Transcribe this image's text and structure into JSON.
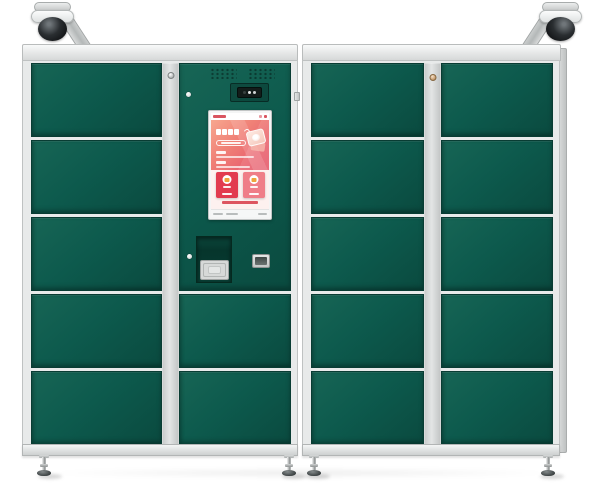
{
  "product": {
    "type": "smart-parcel-locker-cabinets",
    "description": "Two green steel locker cabinets with light gray frames, two dome surveillance cameras on top corners, central control column with touchscreen, QR scanner and card slot, chrome adjustable feet"
  },
  "palette": {
    "door_green": "#0d5a4d",
    "door_green_light": "#176555",
    "door_green_dark": "#0a4a3f",
    "door_edge": "#093c33",
    "frame_light": "#e8eaea",
    "frame_border": "#bfc2c2",
    "strip_silver": "#d9dbdb",
    "chrome": "#9aa0a3",
    "screen_red": "#e55a6b",
    "screen_coral": "#f7a78f",
    "card_red": "#e23b4f",
    "card_coral": "#ef7e88",
    "accent_orange": "#f0a43c",
    "screen_bg_pink": "#fdf1ef"
  },
  "cameras": [
    {
      "name": "surveillance-camera-left",
      "mount": "top-left-corner",
      "style": "dome"
    },
    {
      "name": "surveillance-camera-right",
      "mount": "top-right-corner",
      "style": "dome"
    }
  ],
  "cabinets": {
    "left": {
      "name": "left-cabinet",
      "columns": {
        "left_doors": 5,
        "control_doors": 2
      },
      "lock_strip_keyholes": 1
    },
    "right": {
      "name": "right-cabinet",
      "columns": {
        "left_doors": 5,
        "right_doors": 5
      },
      "lock_strip_keyholes": 1
    }
  },
  "control_panel": {
    "speaker_grilles": 2,
    "camera_module": {
      "leds": 3
    },
    "panel_locks": 2,
    "qr_scanner": {
      "present": true,
      "style": "recessed window with concentric rings"
    },
    "card_slot": {
      "present": true
    },
    "screen": {
      "orientation": "portrait",
      "header": {
        "logo": "red-brand-mark",
        "status_dots": 2
      },
      "hero": {
        "title_glyphs": 4,
        "title_icon": "circular-arrow-icon",
        "subtitle_pill": true,
        "bullet_groups": 2,
        "illustration": "parcel-package-icon"
      },
      "cards": [
        {
          "name": "deposit-card",
          "color": "#e23b4f",
          "icon": "deposit-parcel-icon"
        },
        {
          "name": "pickup-card",
          "color": "#ef7e88",
          "icon": "pickup-parcel-icon"
        }
      ],
      "notice_line": true,
      "footer_items": 3
    }
  }
}
